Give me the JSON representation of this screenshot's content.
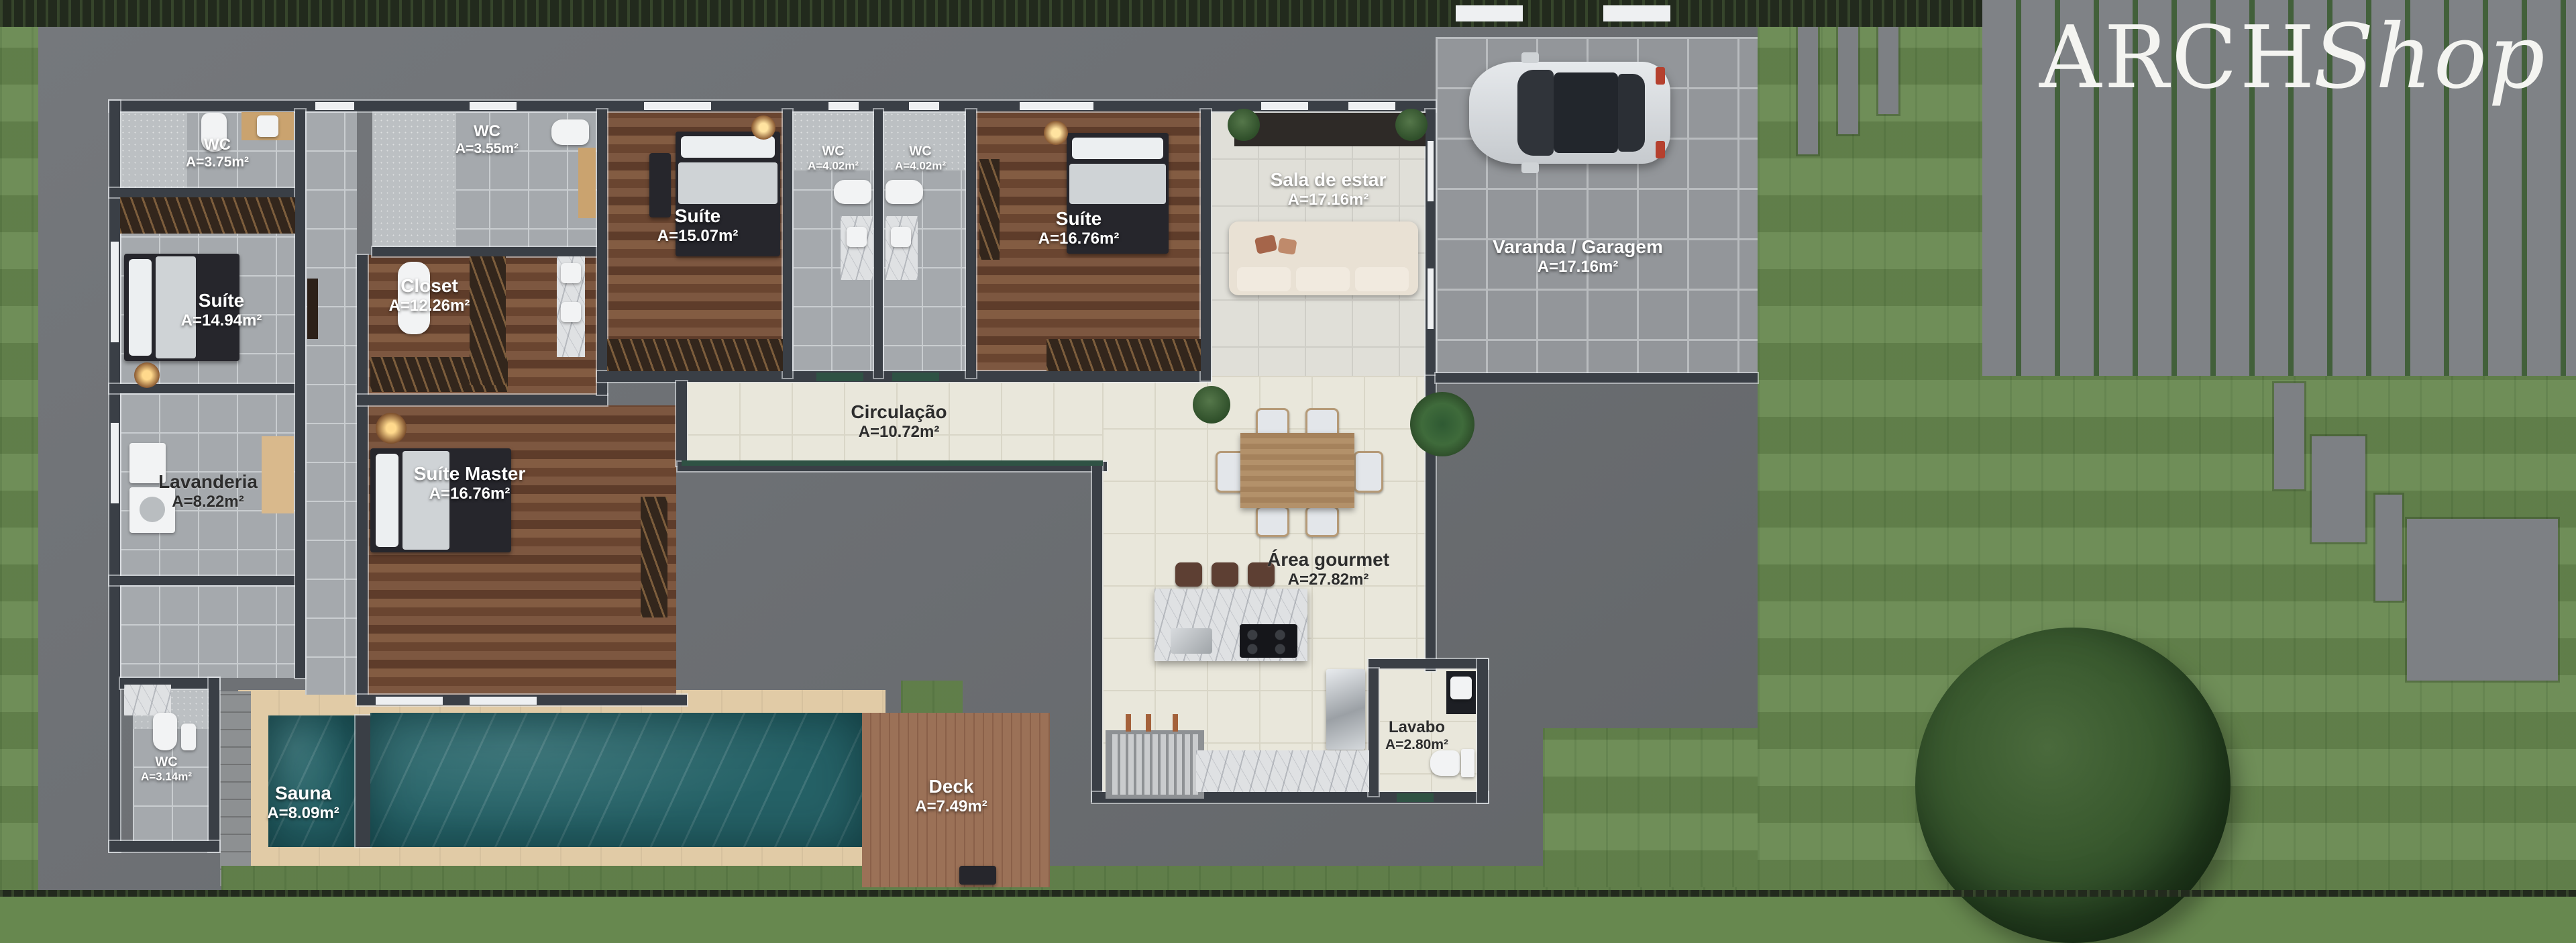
{
  "logo": {
    "part1": "ARCH",
    "part2": "Shop"
  },
  "rooms": {
    "wc_suite1": {
      "name": "WC",
      "area": "A=3.75m²"
    },
    "suite1": {
      "name": "Suíte",
      "area": "A=14.94m²"
    },
    "wc_closet": {
      "name": "WC",
      "area": "A=3.55m²"
    },
    "closet": {
      "name": "Closet",
      "area": "A=12.26m²"
    },
    "suite2": {
      "name": "Suíte",
      "area": "A=15.07m²"
    },
    "wc_suite2": {
      "name": "WC",
      "area": "A=4.02m²"
    },
    "wc_suite3": {
      "name": "WC",
      "area": "A=4.02m²"
    },
    "suite3": {
      "name": "Suíte",
      "area": "A=16.76m²"
    },
    "sala": {
      "name": "Sala de estar",
      "area": "A=17.16m²"
    },
    "varanda": {
      "name": "Varanda / Garagem",
      "area": "A=17.16m²"
    },
    "circulacao": {
      "name": "Circulação",
      "area": "A=10.72m²"
    },
    "suite_master": {
      "name": "Suíte Master",
      "area": "A=16.76m²"
    },
    "lavanderia": {
      "name": "Lavanderia",
      "area": "A=8.22m²"
    },
    "area_gourmet": {
      "name": "Área gourmet",
      "area": "A=27.82m²"
    },
    "wc_sauna": {
      "name": "WC",
      "area": "A=3.14m²"
    },
    "sauna": {
      "name": "Sauna",
      "area": "A=8.09m²"
    },
    "deck": {
      "name": "Deck",
      "area": "A=7.49m²"
    },
    "lavabo": {
      "name": "Lavabo",
      "area": "A=2.80m²"
    }
  },
  "colors": {
    "grass": "#67884f",
    "lot_concrete": "#6f7276",
    "wall": "#3a3f46",
    "wood_floor": "#74492f",
    "cream_tile": "#e9e7db",
    "gray_tile": "#a5a9ad",
    "pool_water": "#256166",
    "pool_coping": "#e1cba6",
    "deck_wood": "#9b7157",
    "logo_text": "#f4f4f1",
    "label_light": "#ffffff",
    "label_dark": "#2d2d2d"
  }
}
